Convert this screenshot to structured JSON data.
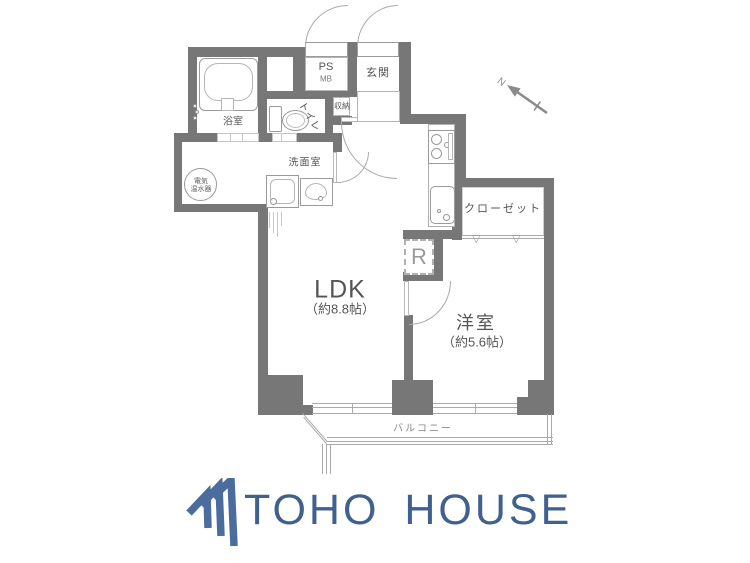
{
  "floorplan": {
    "rooms": {
      "bathroom": "浴室",
      "toilet": "トイレ",
      "washroom": "洗面室",
      "water_heater_line1": "電気",
      "water_heater_line2": "温水器",
      "ps": "PS",
      "mb": "MB",
      "entrance": "玄関",
      "storage": "収納",
      "closet": "クローゼット",
      "refrigerator": "R",
      "ldk": "LDK",
      "ldk_size": "（約8.8帖）",
      "western_room": "洋室",
      "western_room_size": "（約5.6帖）",
      "balcony": "バルコニー"
    },
    "compass": {
      "north": "N"
    }
  },
  "branding": {
    "logo_text": "TOHO HOUSE"
  },
  "colors": {
    "wall": "#777777",
    "logo_text_blue": "#40618e",
    "logo_icon_blue": "#4a6d9e"
  }
}
